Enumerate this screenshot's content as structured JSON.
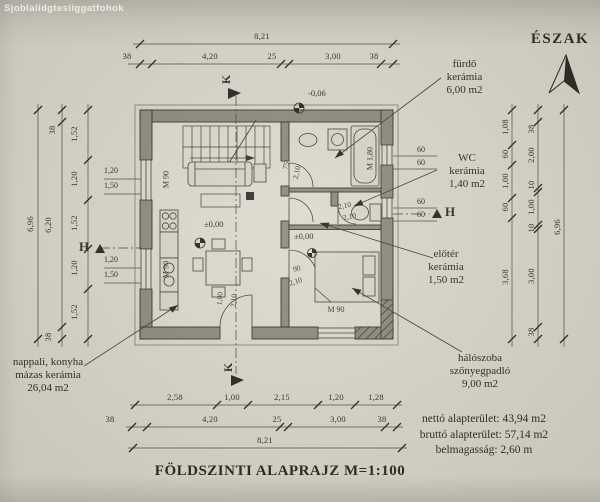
{
  "watermark": "Sjoblalidgtesiiggatfohok",
  "north": "ÉSZAK",
  "title": "FÖLDSZINTI ALAPRAJZ M=1:100",
  "summary": {
    "net": "nettó alapterület: 43,94 m2",
    "gross": "bruttó alapterület: 57,14 m2",
    "height": "belmagasság: 2,60 m"
  },
  "rooms": {
    "bathroom": [
      "fürdő",
      "kerámia",
      "6,00 m2"
    ],
    "wc": [
      "WC",
      "kerámia",
      "1,40 m2"
    ],
    "hall": [
      "előtér",
      "kerámia",
      "1,50 m2"
    ],
    "bedroom": [
      "hálószoba",
      "szőnyegpadló",
      "9,00 m2"
    ],
    "living": [
      "nappali, konyha",
      "mázas kerámia",
      "26,04 m2"
    ]
  },
  "levels": {
    "terrace": "-0,06",
    "living": "±0,00",
    "hall": "±0,00"
  },
  "sections": {
    "k": "K",
    "h": "H"
  },
  "doors": {
    "bath": [
      "75",
      "2,10"
    ],
    "bedroom": [
      "90",
      "2,10"
    ],
    "entry": [
      "1,00",
      "2,10"
    ],
    "wc": "2,10",
    "hall": "2,10"
  },
  "marks": {
    "window_left_1": "M 90",
    "window_left_2": "M 90",
    "bed": "M 90",
    "tub": "M 1,80"
  },
  "sills": {
    "left_1": [
      "1,20",
      "1,50"
    ],
    "left_2": [
      "1,20",
      "1,50"
    ],
    "right_1": [
      "60",
      "60"
    ],
    "right_2": [
      "60",
      "60"
    ]
  },
  "dims": {
    "top_total": "8,21",
    "top": [
      "38",
      "4,20",
      "25",
      "3,00",
      "38"
    ],
    "bottom_inner": [
      "2,58",
      "1,00",
      "2,15",
      "1,20",
      "1,28"
    ],
    "bottom_mid": [
      "38",
      "4,20",
      "25",
      "3,00",
      "38"
    ],
    "bottom_total": "8,21",
    "left_outer": "6,96",
    "left_mid": [
      "38",
      "6,20",
      "38"
    ],
    "left_inner": [
      "1,52",
      "1,20",
      "1,52",
      "1,20",
      "1,52"
    ],
    "right_inner": [
      "1,08",
      "60",
      "1,00",
      "60",
      "3,68"
    ],
    "right_mid": [
      "38",
      "2,00",
      "10",
      "1,00",
      "10",
      "3,00",
      "38"
    ],
    "right_outer": "6,96"
  }
}
